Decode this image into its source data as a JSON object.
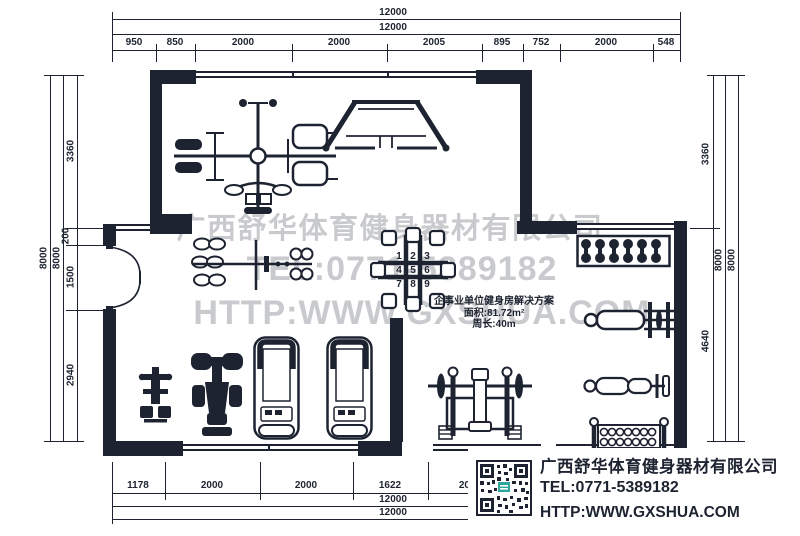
{
  "colors": {
    "ink": "#1d2330",
    "watermark": "#c8cacd",
    "qr_logo_accent": "#2fa59b"
  },
  "dims": {
    "top": {
      "overall_1": "12000",
      "overall_2": "12000",
      "segments": [
        "950",
        "850",
        "2000",
        "2000",
        "2005",
        "895",
        "752",
        "2000",
        "548"
      ]
    },
    "bottom": {
      "segments": [
        "1178",
        "2000",
        "2000",
        "1622",
        "2000"
      ],
      "overall_1": "12000",
      "overall_2": "12000"
    },
    "left": {
      "overall_1": "8000",
      "overall_2": "8000",
      "segments": [
        "3360",
        "200",
        "1500",
        "2940"
      ]
    },
    "right": {
      "segments": [
        "3360",
        "4640"
      ],
      "overall_1": "8000",
      "overall_2": "8000"
    }
  },
  "watermark": {
    "company": "广西舒华体育健身器材有限公司",
    "tel": "TEL:0771-5389182",
    "website": "HTTP:WWW.GXSHUA.COM"
  },
  "solution_box": {
    "title": "企事业单位健身房解决方案",
    "area": "面积:81.72m²",
    "perimeter": "周长:40m"
  },
  "info_box": {
    "company": "广西舒华体育健身器材有限公司",
    "tel": "TEL:0771-5389182",
    "website": "HTTP:WWW.GXSHUA.COM"
  },
  "station_numbers": [
    "1",
    "2",
    "3",
    "4",
    "5",
    "6",
    "7",
    "8",
    "9"
  ]
}
